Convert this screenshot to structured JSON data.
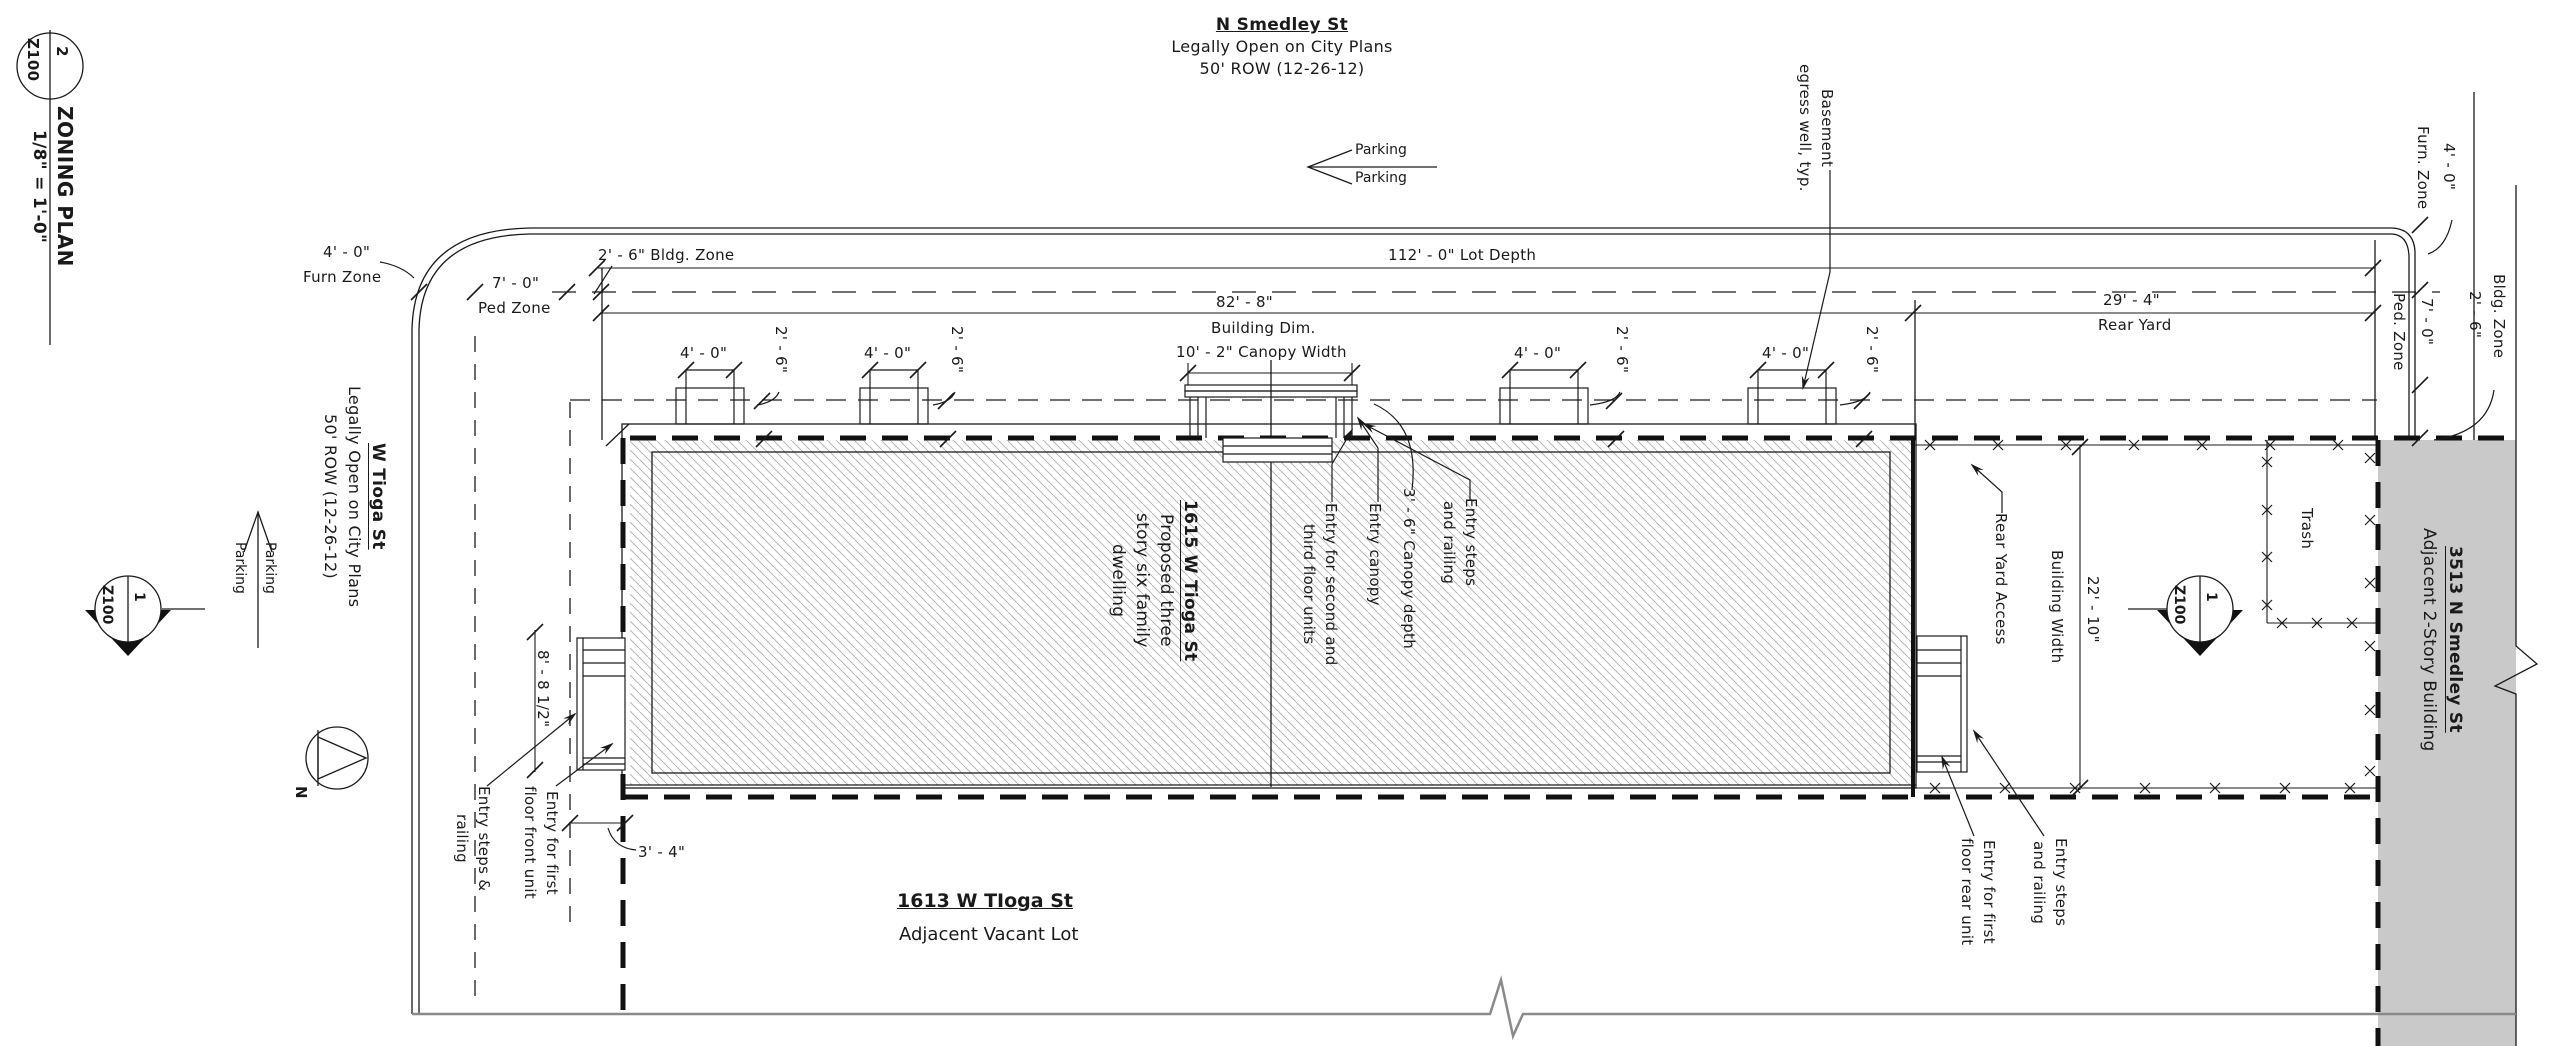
{
  "title_block": {
    "detail_number": "2",
    "sheet_number": "Z100",
    "title": "ZONING PLAN",
    "scale": "1/8\" = 1'-0\""
  },
  "streets": {
    "north": {
      "name": "N Smedley St",
      "status": "Legally Open on City Plans",
      "row": "50' ROW (12-26-12)",
      "parking_upper": "Parking",
      "parking_lower": "Parking"
    },
    "west": {
      "name": "W Tioga St",
      "status": "Legally Open on City Plans",
      "row": "50' ROW (12-26-12)",
      "parking_upper": "Parking",
      "parking_lower": "Parking"
    }
  },
  "compass": {
    "north_label": "N"
  },
  "zones_left": {
    "furn_dim": "4' - 0\"",
    "furn_label": "Furn Zone",
    "ped_dim": "7' - 0\"",
    "ped_label": "Ped Zone",
    "bldg_label": "2' - 6\" Bldg. Zone"
  },
  "zones_right": {
    "furn_dim": "4' - 0\"",
    "furn_label": "Furn. Zone",
    "bldg_dim": "2' - 6\"",
    "bldg_label": "Bldg. Zone",
    "ped_dim": "7' - 0\"",
    "ped_label": "Ped. Zone"
  },
  "dims": {
    "lot_depth": "112' - 0\" Lot Depth",
    "bldg_dim_value": "82' - 8\"",
    "bldg_dim_label": "Building Dim.",
    "canopy_width": "10' - 2\" Canopy Width",
    "rear_yard_value": "29' - 4\"",
    "rear_yard_label": "Rear Yard",
    "bay_width": "4' - 0\"",
    "bay_offset": "2' - 6\"",
    "front_entry_width": "8' - 8 1/2\"",
    "front_entry_offset": "3' - 4\"",
    "rear_bldg_width_value": "22' - 10\"",
    "rear_bldg_width_label": "Building Width"
  },
  "building": {
    "address": "1615 W Tioga St",
    "desc": [
      "Proposed three",
      "story six family",
      "dwelling"
    ]
  },
  "annotations": {
    "basement": [
      "Basement",
      "egress well, typ."
    ],
    "entry_upper": [
      "Entry for second and",
      "third floor units"
    ],
    "entry_canopy": "Entry canopy",
    "canopy_depth": "3' - 6\" Canopy depth",
    "entry_steps_mid": [
      "Entry steps",
      "and railing"
    ],
    "entry_steps_left": [
      "Entry steps &",
      "railing"
    ],
    "entry_front": [
      "Entry for first",
      "floor front unit"
    ],
    "entry_rear": [
      "Entry for first",
      "floor rear unit"
    ],
    "entry_steps_right": [
      "Entry steps",
      "and railing"
    ],
    "rear_yard_access": "Rear Yard Access",
    "trash": "Trash"
  },
  "markers": {
    "section_left": {
      "num": "1",
      "sheet": "Z100"
    },
    "section_rear": {
      "num": "1",
      "sheet": "Z100"
    }
  },
  "neighbors": {
    "vacant_lot": {
      "address": "1613 W TIoga St",
      "desc": "Adjacent Vacant Lot"
    },
    "smedley_bldg": {
      "address": "3513 N Smedley St",
      "desc": "Adjacent 2-Story Building"
    }
  },
  "colors": {
    "line": "#1a1a1a",
    "hatch": "#b7b7b7",
    "neighbor_fill": "#c9c9c9",
    "ground_line": "#8a8a8a"
  }
}
